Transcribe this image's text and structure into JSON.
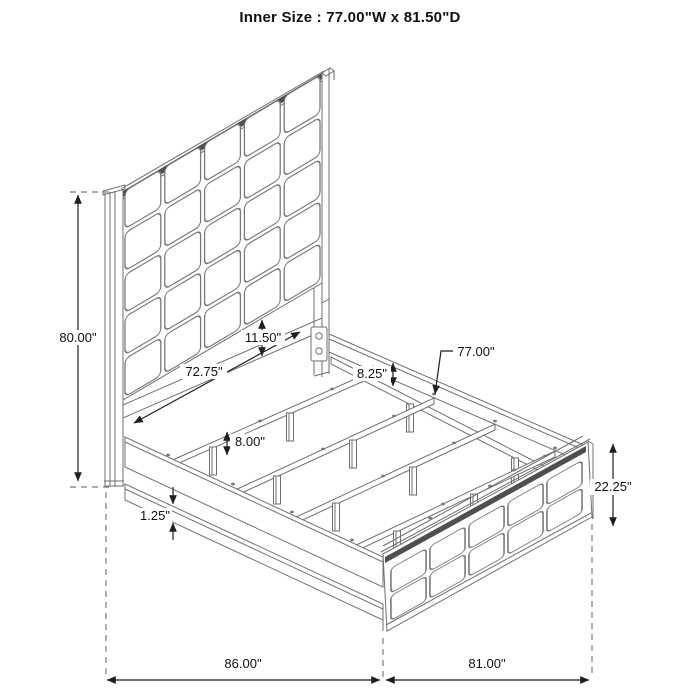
{
  "title": "Inner Size : 77.00\"W x 81.50\"D",
  "dimensions": {
    "headboard_height": "80.00\"",
    "rail_length": "72.75\"",
    "headboard_gap": "11.50\"",
    "rail_height": "8.25\"",
    "slat_length": "77.00\"",
    "leg_height": "8.00\"",
    "trim_thickness": "1.25\"",
    "footboard_height": "22.25\"",
    "overall_length": "86.00\"",
    "overall_width": "81.00\""
  },
  "colors": {
    "line": "#6f6f6f",
    "dimension": "#1f1f1f",
    "dark_band": "#4f4f4f",
    "background": "#ffffff"
  }
}
